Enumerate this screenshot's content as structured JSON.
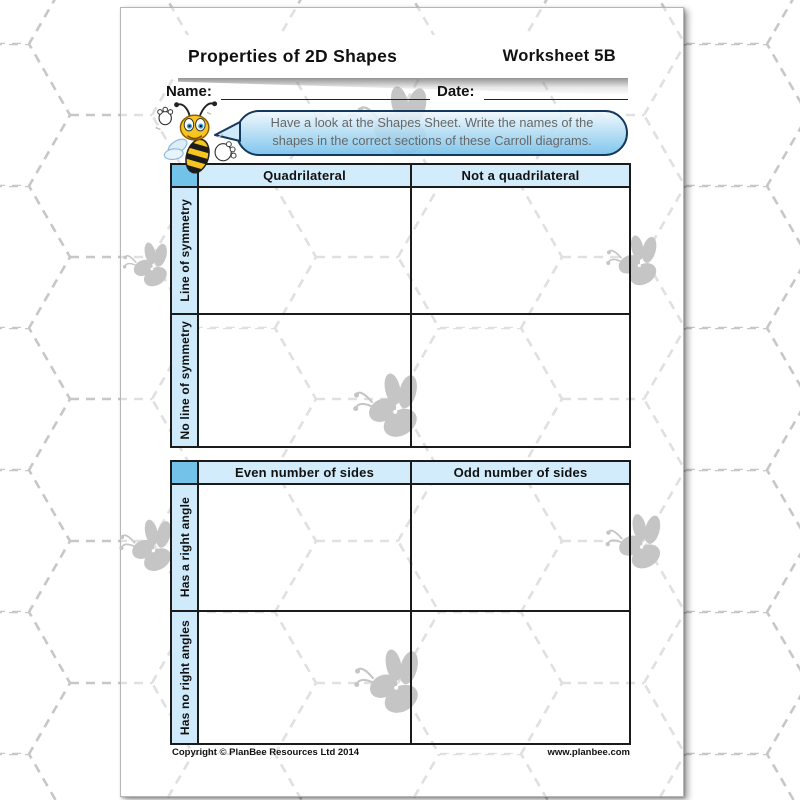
{
  "header": {
    "title": "Properties of 2D Shapes",
    "worksheet": "Worksheet 5B"
  },
  "fields": {
    "name_label": "Name:",
    "date_label": "Date:"
  },
  "bubble": {
    "text": "Have a look at the Shapes Sheet. Write the names of the shapes in the correct sections of these Carroll diagrams."
  },
  "tables": [
    {
      "columns": [
        "Quadrilateral",
        "Not a quadrilateral"
      ],
      "rows": [
        "Line of symmetry",
        "No line of symmetry"
      ]
    },
    {
      "columns": [
        "Even number of sides",
        "Odd number of sides"
      ],
      "rows": [
        "Has a right angle",
        "Has no right angles"
      ]
    }
  ],
  "footer": {
    "left": "Copyright © PlanBee Resources Ltd 2014",
    "right": "www.planbee.com"
  },
  "icons": {
    "mascot": "bee-mascot",
    "watermark": "bee-silhouette",
    "background": "dashed-hexagon-pattern"
  },
  "colors": {
    "column_header_fill": "#d2ecfb",
    "row_header_fill": "#cfeafa",
    "corner_cell_fill": "#72c2ea",
    "table_border": "#1b1b1b",
    "bubble_border": "#14395c",
    "bubble_fill_top": "#eef7fd",
    "bubble_fill_bottom": "#76c0eb",
    "bubble_text": "#676767",
    "hexagon_line": "#c7c7c7",
    "watermark_gray": "#c5c5c5"
  }
}
